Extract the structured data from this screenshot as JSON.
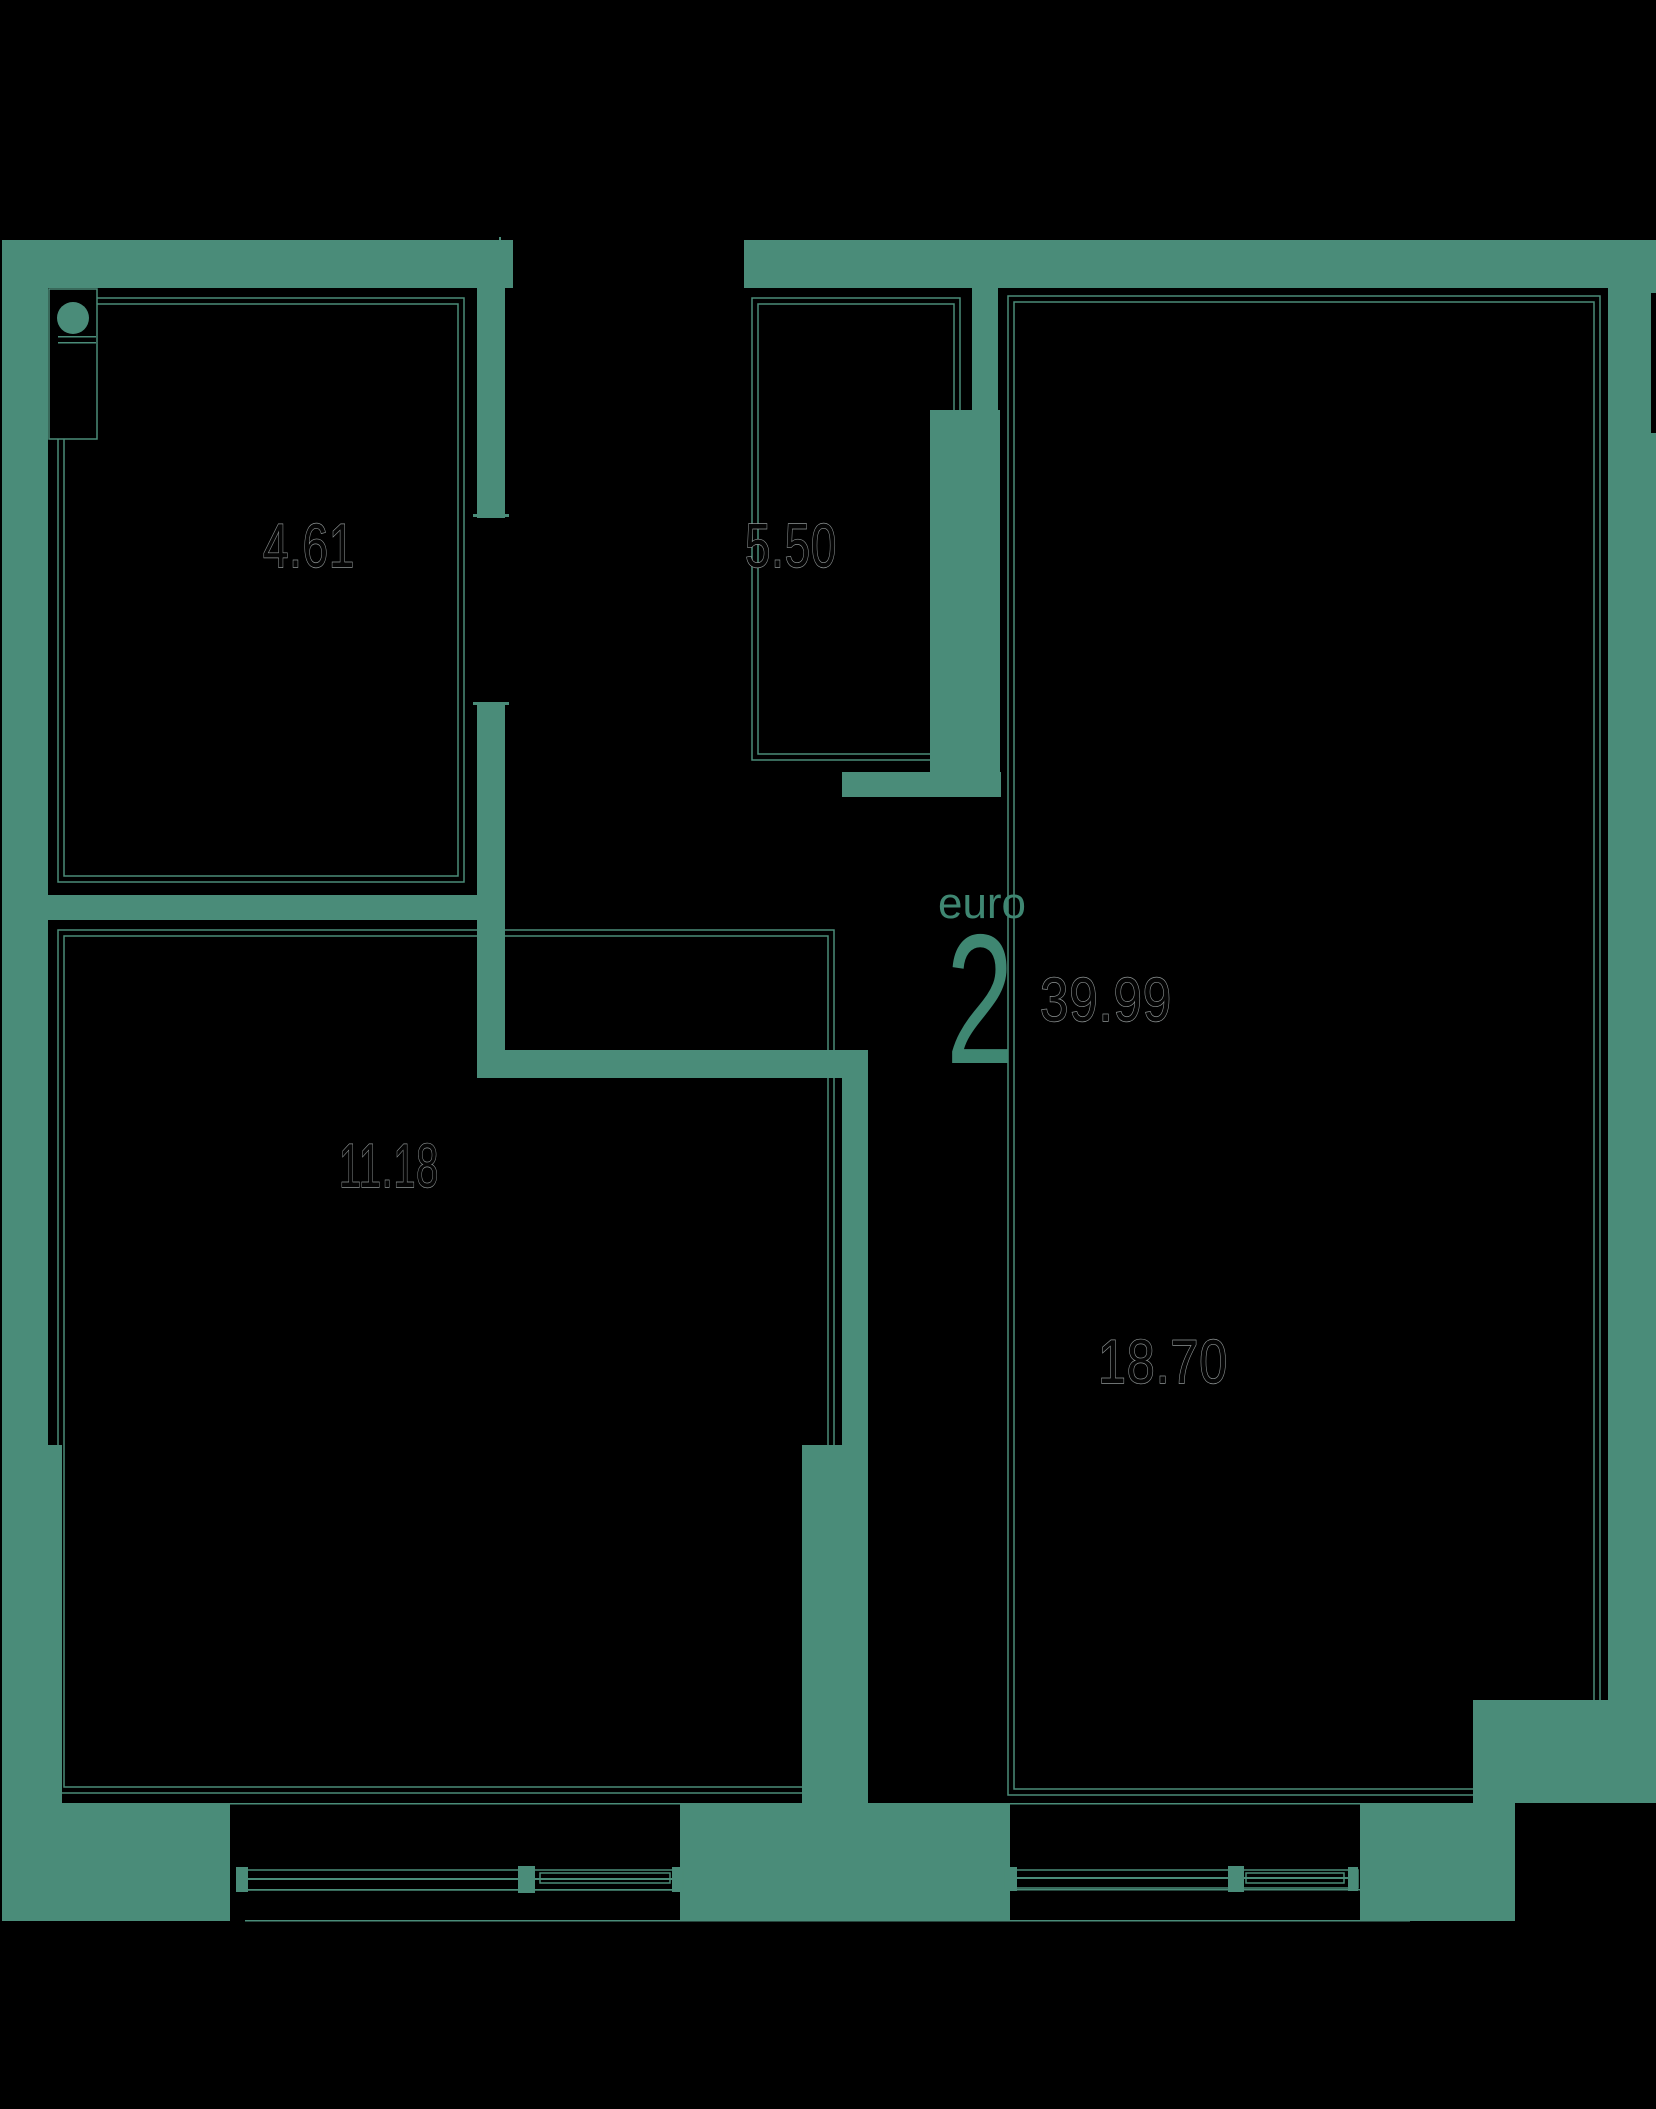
{
  "meta": {
    "background_color": "#000000",
    "wall_color": "#4a8c79",
    "accent_color": "#3f8772",
    "area_text_outline_color": "#8f9595"
  },
  "plan": {
    "unit_type_label": "euro",
    "unit_rooms_count": "2",
    "unit_total_area": "39.99",
    "rooms": [
      {
        "id": "bathroom",
        "area_label": "4.61"
      },
      {
        "id": "hallway",
        "area_label": "5.50"
      },
      {
        "id": "bedroom",
        "area_label": "11.18"
      },
      {
        "id": "living-room",
        "area_label": "18.70"
      }
    ]
  }
}
